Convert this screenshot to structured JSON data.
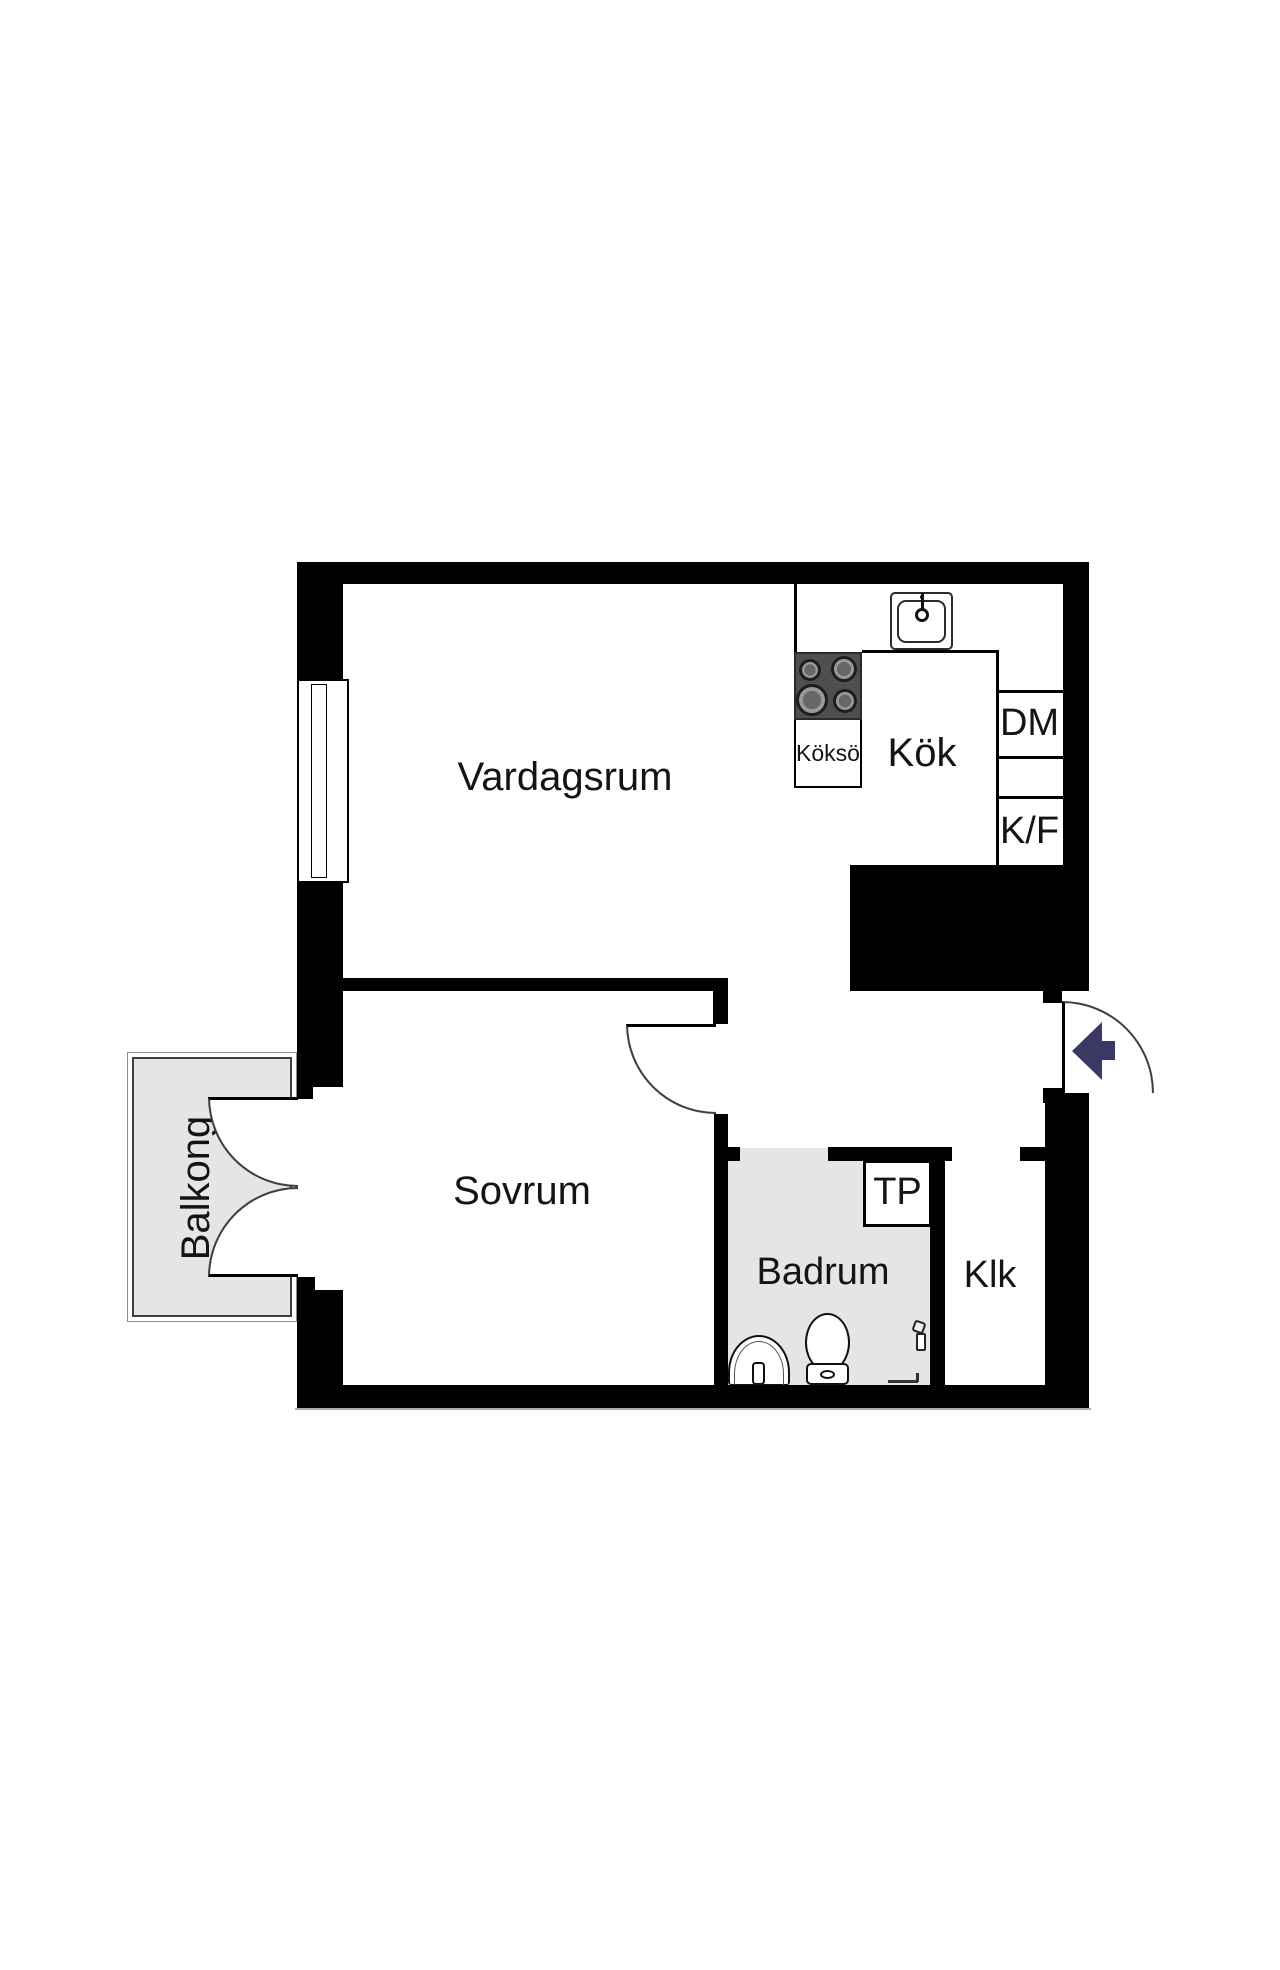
{
  "plan": {
    "rooms": {
      "vardagsrum": {
        "label": "Vardagsrum"
      },
      "kok": {
        "label": "Kök"
      },
      "kokso": {
        "label": "Köksö"
      },
      "dm": {
        "label": "DM"
      },
      "kf": {
        "label": "K/F"
      },
      "sovrum": {
        "label": "Sovrum"
      },
      "badrum": {
        "label": "Badrum"
      },
      "tp": {
        "label": "TP"
      },
      "klk": {
        "label": "Klk"
      },
      "balkong": {
        "label": "Balkong"
      }
    },
    "colors": {
      "wall": "#000000",
      "background": "#ffffff",
      "wet_room_floor": "#e5e5e7",
      "balcony_floor": "#e5e5e7",
      "stove": "#4f4f51",
      "burner_ring": "#98989a",
      "door_arc": "#3f3f3f",
      "entry_arrow": "#3c3866"
    },
    "icons": {
      "entry_arrow": "left-arrow-icon",
      "kitchen_sink": "sink-icon",
      "stove": "cooktop-4-burner-icon",
      "bathroom_sink": "washbasin-icon",
      "toilet": "toilet-icon",
      "shower_mixer": "tap-icon",
      "window": "window-icon",
      "french_doors": "double-door-icon"
    }
  }
}
